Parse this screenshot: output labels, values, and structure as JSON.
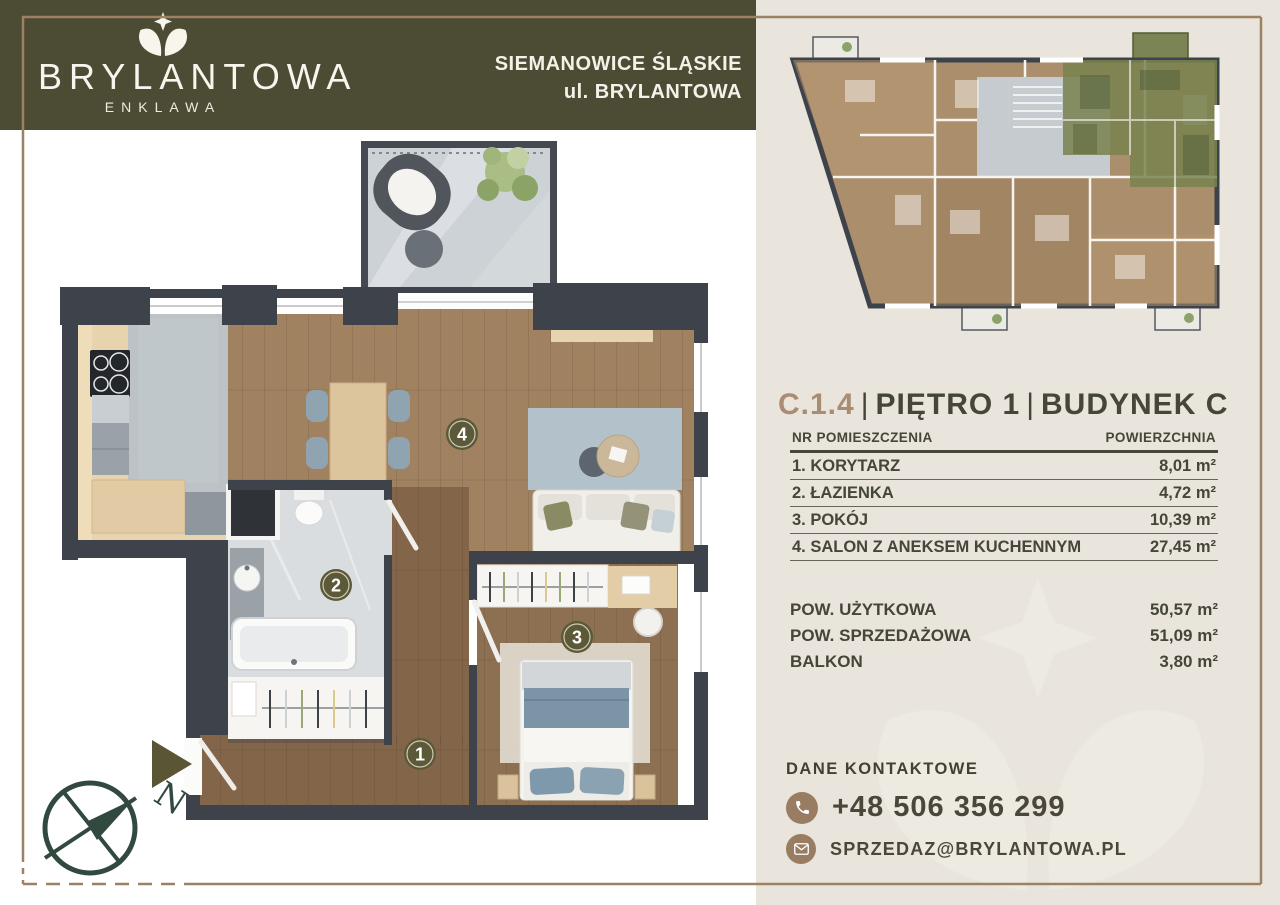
{
  "brand": {
    "name": "BRYLANTOWA",
    "subtitle": "ENKLAWA",
    "location_line1": "SIEMANOWICE ŚLĄSKIE",
    "location_line2": "ul. BRYLANTOWA"
  },
  "unit": {
    "code": "C.1.4",
    "separator": "|",
    "floor_label": "PIĘTRO 1",
    "building_label": "BUDYNEK C"
  },
  "rooms_table": {
    "header_name": "NR POMIESZCZENIA",
    "header_area": "POWIERZCHNIA",
    "rows": [
      {
        "name": "1. KORYTARZ",
        "area": "8,01 m²"
      },
      {
        "name": "2. ŁAZIENKA",
        "area": "4,72 m²"
      },
      {
        "name": "3. POKÓJ",
        "area": "10,39 m²"
      },
      {
        "name": "4. SALON Z ANEKSEM KUCHENNYM",
        "area": "27,45 m²"
      }
    ]
  },
  "summary": {
    "rows": [
      {
        "label": "POW. UŻYTKOWA",
        "value": "50,57 m²"
      },
      {
        "label": "POW. SPRZEDAŻOWA",
        "value": "51,09 m²"
      },
      {
        "label": "BALKON",
        "value": "3,80 m²"
      }
    ]
  },
  "contact": {
    "heading": "DANE KONTAKTOWE",
    "phone": "+48 506 356 299",
    "email": "SPRZEDAZ@BRYLANTOWA.PL"
  },
  "floor_plan": {
    "badges": [
      "1",
      "2",
      "3",
      "4"
    ],
    "compass_label": "N"
  },
  "colors": {
    "header_olive": "#4c4b34",
    "panel_beige": "#e9e5dc",
    "frame_tan": "#9b8264",
    "accent_tan": "#aa8c73",
    "text_dark": "#45453a",
    "badge_olive": "#5c5939",
    "wall_dark": "#3e434b",
    "highlight_unit_green": "#78834f",
    "contact_circle_brown": "#997d63"
  }
}
